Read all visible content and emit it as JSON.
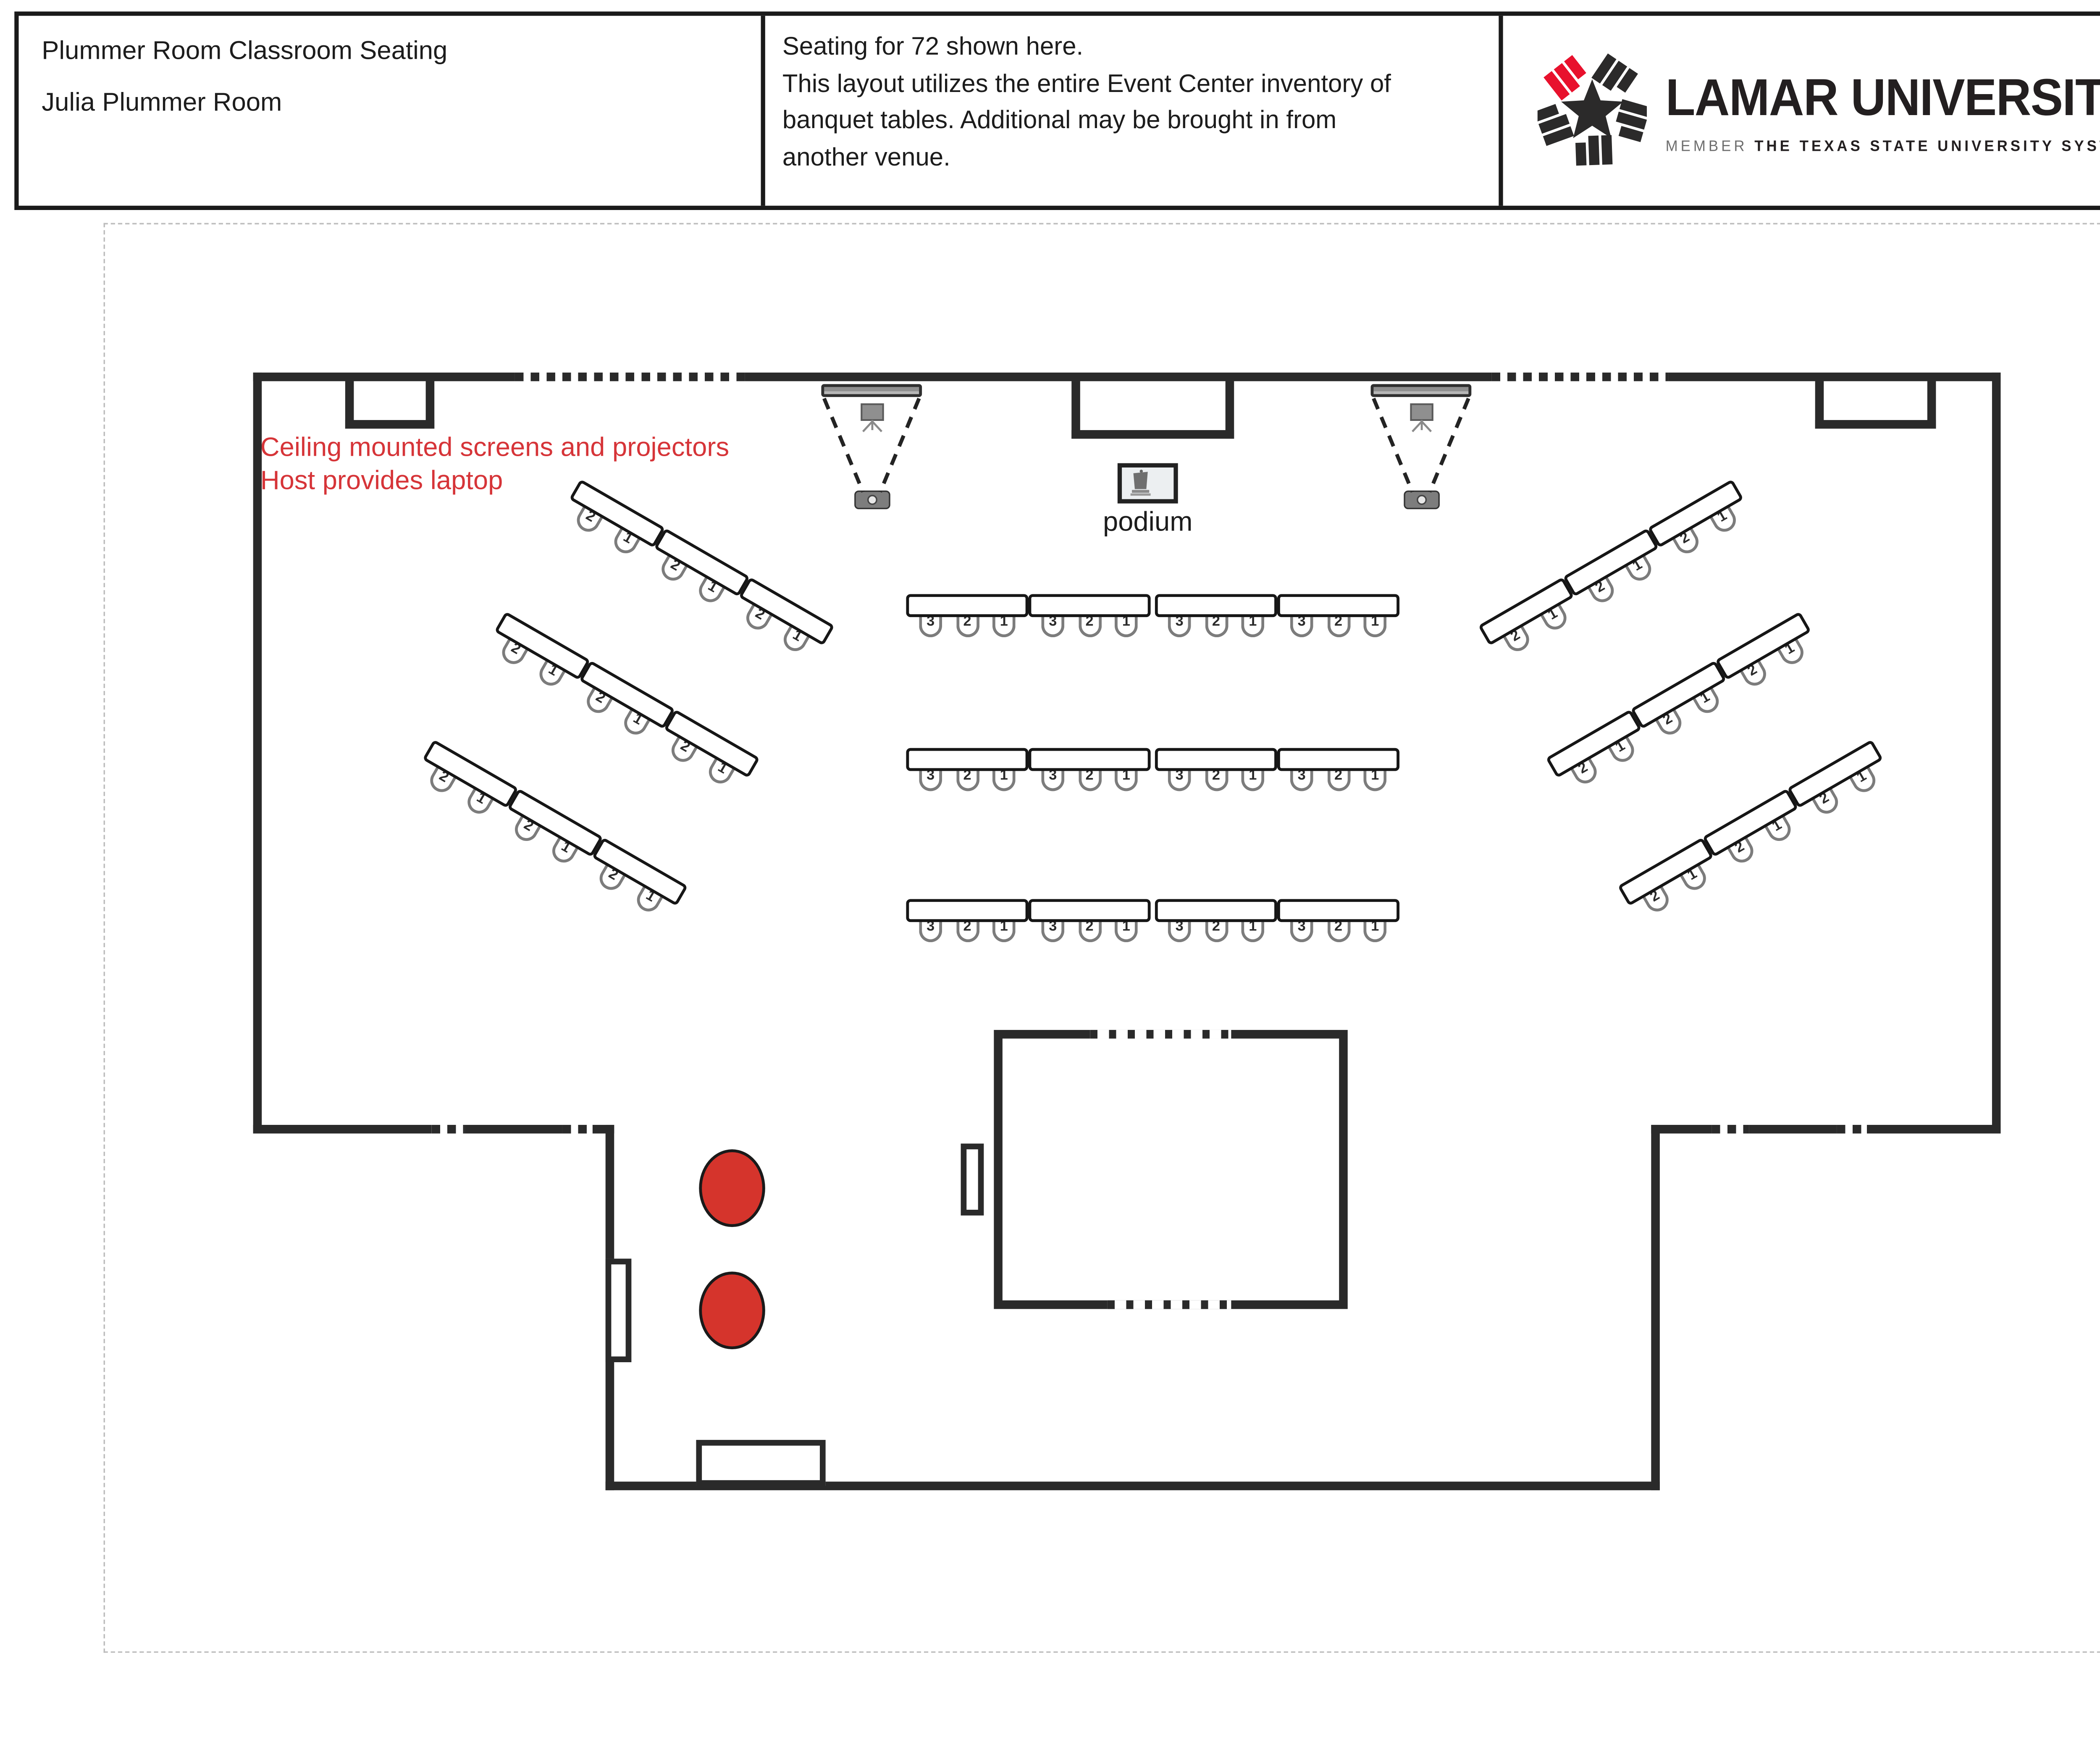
{
  "header": {
    "left": {
      "line1": "Plummer Room Classroom Seating",
      "line2": "Julia Plummer Room"
    },
    "center": {
      "lines": [
        "Seating for 72 shown here.",
        "This layout utilizes the entire Event Center inventory of",
        "banquet tables. Additional may be brought in from",
        "another venue."
      ]
    },
    "logo": {
      "wordmark": "LAMAR UNIVERSITY",
      "member": "MEMBER",
      "system": "THE TEXAS STATE UNIVERSITY SYSTEM",
      "trademark": "TM",
      "color_black": "#231f20",
      "color_red": "#e8112d"
    }
  },
  "plan": {
    "wall_color": "#2a2a2a",
    "annotation": {
      "line1": "Ceiling mounted screens and projectors",
      "line2": "Host provides laptop",
      "color": "#d63438"
    },
    "podium_label": "podium",
    "icons": [
      "projector-screen-icon",
      "projector-icon",
      "tripod-screen-icon",
      "podium-icon",
      "chair-icon",
      "lu-star-icon"
    ],
    "marker_circle_color": "#d5342c",
    "seating": {
      "total_shown": "72",
      "seat_labels_center_table": [
        "3",
        "2",
        "1"
      ],
      "seat_labels_wing_table": [
        "2",
        "1"
      ],
      "center_rows": [
        {
          "name": "center-row-1",
          "tables": [
            [
              "3",
              "2",
              "1"
            ],
            [
              "3",
              "2",
              "1"
            ],
            [
              "3",
              "2",
              "1"
            ],
            [
              "3",
              "2",
              "1"
            ]
          ]
        },
        {
          "name": "center-row-2",
          "tables": [
            [
              "3",
              "2",
              "1"
            ],
            [
              "3",
              "2",
              "1"
            ],
            [
              "3",
              "2",
              "1"
            ],
            [
              "3",
              "2",
              "1"
            ]
          ]
        },
        {
          "name": "center-row-3",
          "tables": [
            [
              "3",
              "2",
              "1"
            ],
            [
              "3",
              "2",
              "1"
            ],
            [
              "3",
              "2",
              "1"
            ],
            [
              "3",
              "2",
              "1"
            ]
          ]
        }
      ],
      "left_rows": [
        {
          "name": "left-row-1",
          "tables": [
            [
              "2",
              "1"
            ],
            [
              "2",
              "1"
            ],
            [
              "2",
              "1"
            ]
          ]
        },
        {
          "name": "left-row-2",
          "tables": [
            [
              "2",
              "1"
            ],
            [
              "2",
              "1"
            ],
            [
              "2",
              "1"
            ]
          ]
        },
        {
          "name": "left-row-3",
          "tables": [
            [
              "2",
              "1"
            ],
            [
              "2",
              "1"
            ],
            [
              "2",
              "1"
            ]
          ]
        }
      ],
      "right_rows": [
        {
          "name": "right-row-1",
          "tables": [
            [
              "2",
              "1"
            ],
            [
              "2",
              "1"
            ],
            [
              "2",
              "1"
            ]
          ]
        },
        {
          "name": "right-row-2",
          "tables": [
            [
              "2",
              "1"
            ],
            [
              "2",
              "1"
            ],
            [
              "2",
              "1"
            ]
          ]
        },
        {
          "name": "right-row-3",
          "tables": [
            [
              "2",
              "1"
            ],
            [
              "2",
              "1"
            ],
            [
              "2",
              "1"
            ]
          ]
        }
      ]
    }
  }
}
